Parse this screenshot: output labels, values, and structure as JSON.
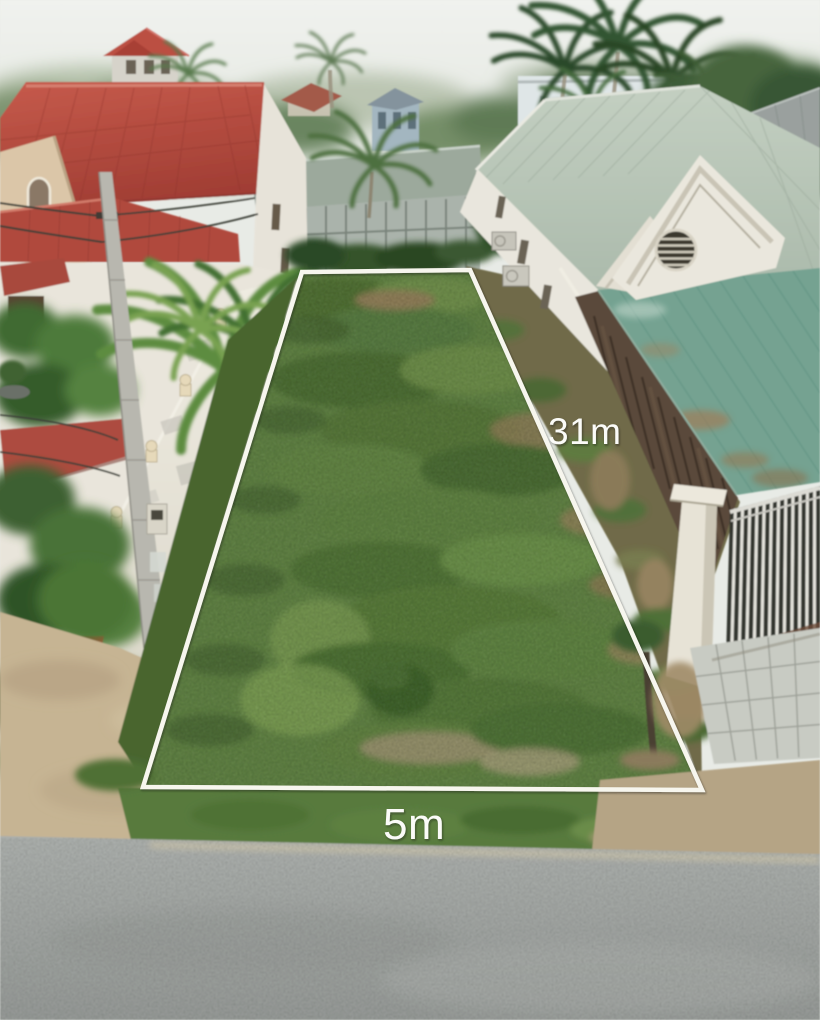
{
  "annotations": {
    "side_length_label": "31m",
    "frontage_length_label": "5m",
    "outline_color": "#f7f6ee",
    "label_color": "#fbfbf8"
  },
  "scene_colors": {
    "sky": "#eaece7",
    "left_roof_red": "#b5483d",
    "right_roof_sage": "#b3c2b3",
    "awning_teal": "#74a291",
    "plot_grass": "#5e7f42",
    "road_asphalt": "#a3a7a4"
  }
}
